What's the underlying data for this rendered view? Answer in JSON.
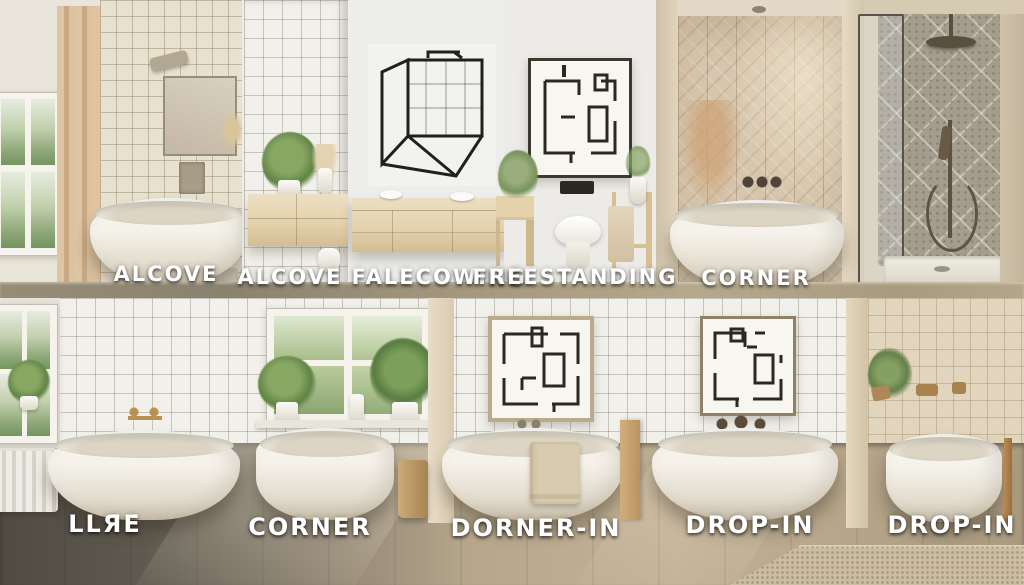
{
  "image_type": "photo-collage illustration of bathtub styles in two rows of bathroom vignettes",
  "labels": {
    "top": [
      "ALCOVE",
      "ALCOVE FALECOWING",
      "FREESTANDING",
      "CORNER"
    ],
    "bottom": [
      "LLЯE",
      "CORNER",
      "DORNER-IN",
      "DROP-IN",
      "DROP-IN"
    ]
  },
  "palette": {
    "label_text": "#ffffff",
    "label_shadow": "#1f1c17",
    "cream_tile": "#e7e1d0",
    "white_tile": "#f1f0ea",
    "warm_tile": "#e2d5bd",
    "herringbone_tile": "#d6c6ad",
    "pattern_tile": "#a49d8e",
    "curtain": "#d7bd9b",
    "wood_vanity": "#e8d9ba",
    "tub_white": "#f8f6f0",
    "floor_dark": "#57534a",
    "floor_tan": "#bfae93",
    "greenery": "#6f9157",
    "brass": "#b98f4e",
    "dark_fixture": "#4e4437"
  }
}
